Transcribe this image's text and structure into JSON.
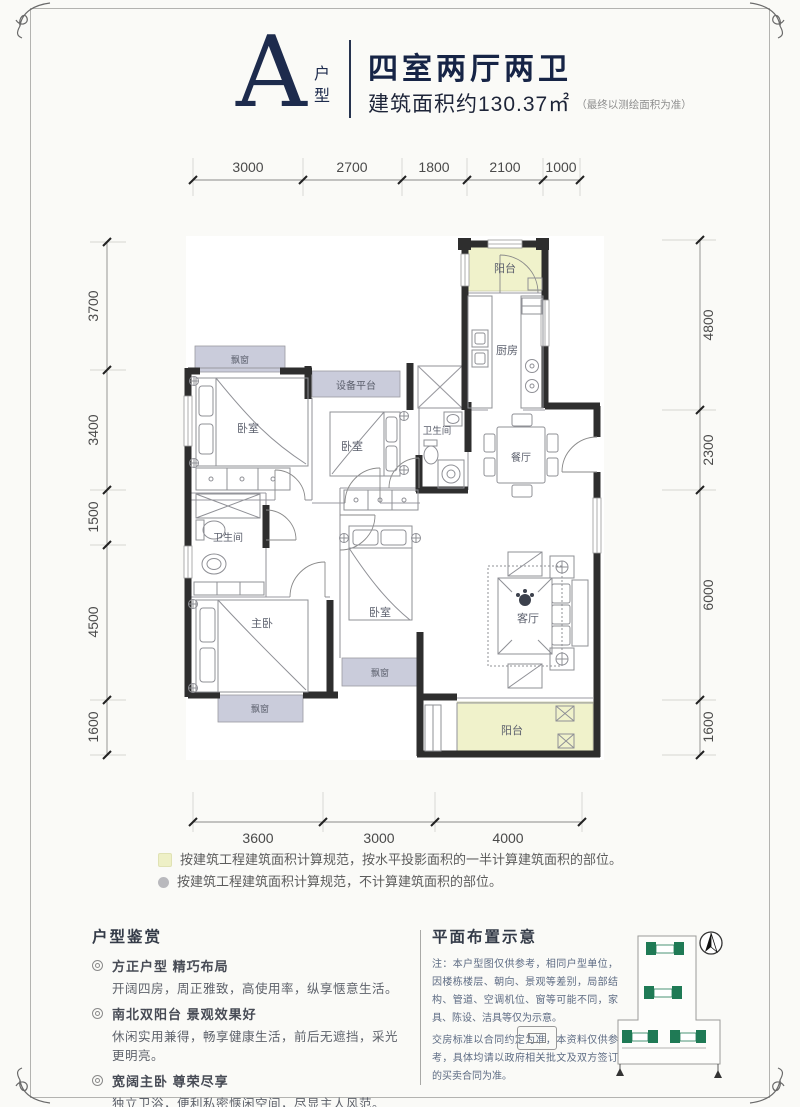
{
  "header": {
    "type_letter": "A",
    "type_label": "户型",
    "title": "四室两厅两卫",
    "area": "建筑面积约130.37㎡",
    "area_note": "（最终以测绘面积为准）"
  },
  "dimensions": {
    "top": [
      "3000",
      "2700",
      "1800",
      "2100",
      "1000"
    ],
    "left": [
      "3700",
      "3400",
      "1500",
      "4500",
      "1600"
    ],
    "right": [
      "4800",
      "2300",
      "6000",
      "1600"
    ],
    "bottom": [
      "3600",
      "3000",
      "4000"
    ]
  },
  "rooms": {
    "balcony_north": "阳台",
    "kitchen": "厨房",
    "bay_window_1": "飘窗",
    "bedroom_1": "卧室",
    "equipment_platform": "设备平台",
    "bedroom_2": "卧室",
    "bathroom_1": "卫生间",
    "dining": "餐厅",
    "bathroom_2": "卫生间",
    "master_bedroom": "主卧",
    "bay_window_2": "飘窗",
    "bedroom_3": "卧室",
    "bay_window_3": "飘窗",
    "living": "客厅",
    "balcony_south": "阳台"
  },
  "legend": {
    "half_area_note": "按建筑工程建筑面积计算规范，按水平投影面积的一半计算建筑面积的部位。",
    "excluded_note": "按建筑工程建筑面积计算规范，不计算建筑面积的部位。"
  },
  "appreciation": {
    "title": "户型鉴赏",
    "items": [
      {
        "headline": "方正户型 精巧布局",
        "detail": "开阔四房，周正雅致，高使用率，纵享惬意生活。"
      },
      {
        "headline": "南北双阳台 景观效果好",
        "detail": "休闲实用兼得，畅享健康生活，前后无遮挡，采光更明亮。"
      },
      {
        "headline": "宽阔主卧 尊荣尽享",
        "detail": "独立卫浴，便利私密惬闲空间，尽显主人风范。"
      }
    ]
  },
  "site_plan": {
    "title": "平面布置示意",
    "note_1": "注：本户型图仅供参考，相同户型单位，因楼栋楼层、朝向、景观等差别，局部结构、管道、空调机位、窗等可能不同，家具、陈设、洁具等仅为示意。",
    "note_2": "交房标准以合同约定为准，本资料仅供参考，具体均请以政府相关批文及双方签订的买卖合同为准。"
  },
  "colors": {
    "accent_navy": "#1d2b4d",
    "wall": "#2e2e2e",
    "balcony_fill": "#f0f2cb",
    "bay_fill": "#caccdb",
    "site_green": "#1f7a55"
  }
}
